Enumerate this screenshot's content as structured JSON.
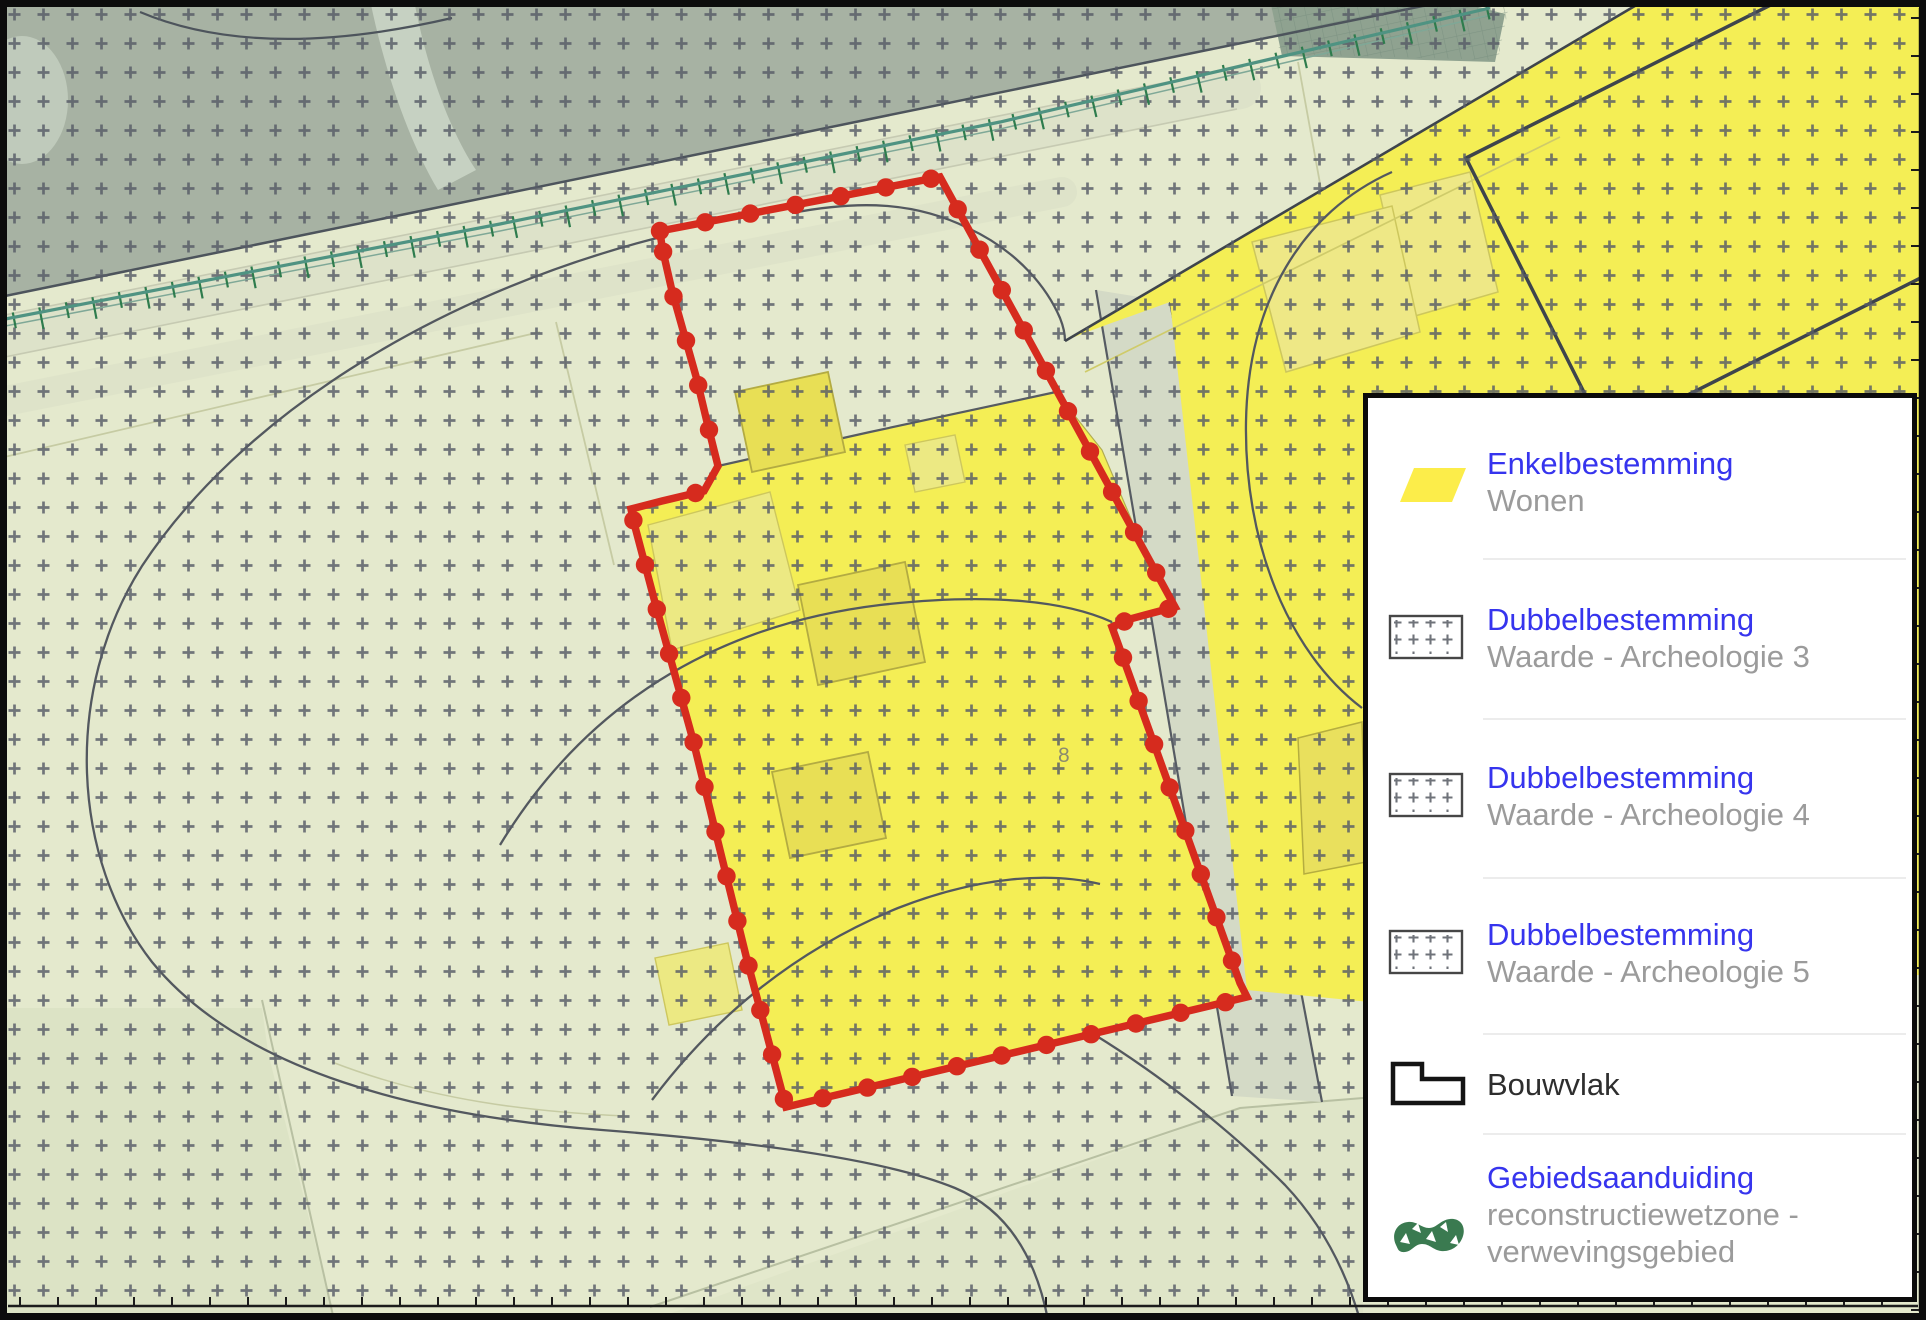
{
  "legend": {
    "items": [
      {
        "title": "Enkelbestemming",
        "subtitle": "Wonen",
        "icon": "wonen-parallelogram"
      },
      {
        "title": "Dubbelbestemming",
        "subtitle": "Waarde - Archeologie 3",
        "icon": "archeologie-hatch"
      },
      {
        "title": "Dubbelbestemming",
        "subtitle": "Waarde - Archeologie 4",
        "icon": "archeologie-hatch"
      },
      {
        "title": "Dubbelbestemming",
        "subtitle": "Waarde - Archeologie 5",
        "icon": "archeologie-hatch"
      },
      {
        "title": "Bouwvlak",
        "subtitle": "",
        "icon": "bouwvlak-outline"
      },
      {
        "title": "Gebiedsaanduiding",
        "subtitle_line1": "reconstructiewetzone -",
        "subtitle_line2": "verwevingsgebied",
        "icon": "gebiedsaanduiding-blob"
      }
    ]
  },
  "map": {
    "parcel_label": "8",
    "plan_boundary": [
      [
        660,
        231
      ],
      [
        940,
        177
      ],
      [
        1175,
        607
      ],
      [
        1130,
        619
      ],
      [
        1112,
        627
      ],
      [
        1240,
        983
      ],
      [
        1247,
        997
      ],
      [
        786,
        1107
      ],
      [
        747,
        960
      ],
      [
        693,
        740
      ],
      [
        657,
        610
      ],
      [
        634,
        523
      ],
      [
        631,
        509
      ],
      [
        662,
        501
      ],
      [
        704,
        491
      ],
      [
        718,
        466
      ],
      [
        707,
        422
      ],
      [
        697,
        380
      ],
      [
        672,
        291
      ],
      [
        662,
        247
      ]
    ],
    "hedge_line": [
      [
        0,
        320
      ],
      [
        500,
        224
      ],
      [
        1000,
        122
      ],
      [
        1490,
        8
      ]
    ],
    "colors": {
      "boundary_red": "#d62b1e",
      "wonen_yellow": "#f4ee55",
      "legend_yellow": "#fced4a",
      "background_pale": "#e4e9cd",
      "sage_dark": "#a7b2a3",
      "hedge_green": "#4f9382",
      "tick_green": "#2e7c4d",
      "cross_gray": "#575c66",
      "parcel_line": "#53585f",
      "gebied_green": "#3a7a50",
      "legend_blue": "#3634ee",
      "legend_gray": "#9b9b9b"
    }
  }
}
